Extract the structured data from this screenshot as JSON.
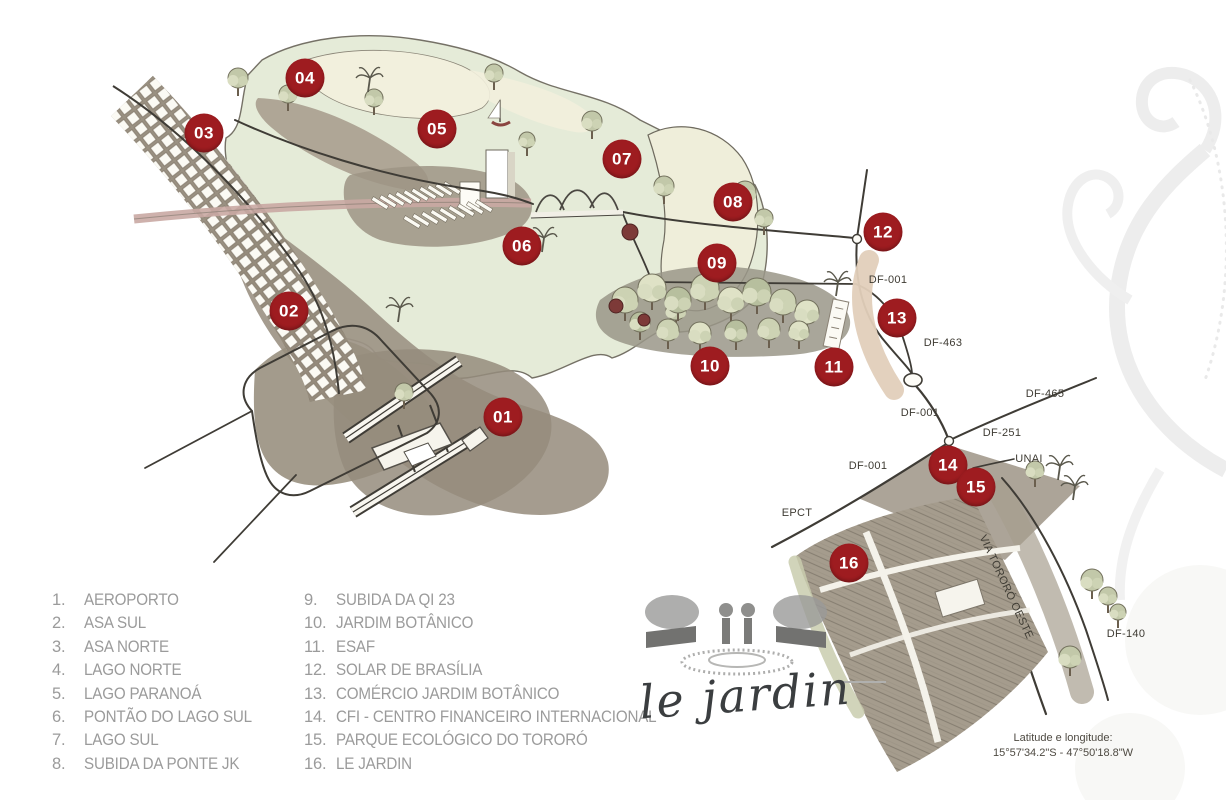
{
  "colors": {
    "marker_bg": "#9e1c20",
    "marker_text": "#ffffff",
    "road_label": "#3e3b33",
    "legend_text": "#9b9b9b",
    "coords_text": "#4e4a42",
    "logo_text": "#3b3e40",
    "water": "#e4ead6",
    "land": "#9d9485",
    "road": "#3f3c36",
    "axis_pink": "#c9a9a3"
  },
  "map": {
    "markers": [
      {
        "num": "01",
        "x": 503,
        "y": 417
      },
      {
        "num": "02",
        "x": 289,
        "y": 311
      },
      {
        "num": "03",
        "x": 204,
        "y": 133
      },
      {
        "num": "04",
        "x": 305,
        "y": 78
      },
      {
        "num": "05",
        "x": 437,
        "y": 129
      },
      {
        "num": "06",
        "x": 522,
        "y": 246
      },
      {
        "num": "07",
        "x": 622,
        "y": 159
      },
      {
        "num": "08",
        "x": 733,
        "y": 202
      },
      {
        "num": "09",
        "x": 717,
        "y": 263
      },
      {
        "num": "10",
        "x": 710,
        "y": 366
      },
      {
        "num": "11",
        "x": 834,
        "y": 367
      },
      {
        "num": "12",
        "x": 883,
        "y": 232
      },
      {
        "num": "13",
        "x": 897,
        "y": 318
      },
      {
        "num": "14",
        "x": 948,
        "y": 465
      },
      {
        "num": "15",
        "x": 976,
        "y": 487
      },
      {
        "num": "16",
        "x": 849,
        "y": 563
      }
    ],
    "road_labels": [
      {
        "text": "DF-001",
        "x": 888,
        "y": 280,
        "rotate": 0
      },
      {
        "text": "DF-463",
        "x": 943,
        "y": 343,
        "rotate": 0
      },
      {
        "text": "DF-465",
        "x": 1045,
        "y": 394,
        "rotate": 0
      },
      {
        "text": "DF-001",
        "x": 920,
        "y": 413,
        "rotate": 0
      },
      {
        "text": "DF-251",
        "x": 1002,
        "y": 433,
        "rotate": 0
      },
      {
        "text": "UNAI",
        "x": 1029,
        "y": 459,
        "rotate": 0
      },
      {
        "text": "DF-001",
        "x": 868,
        "y": 466,
        "rotate": 0
      },
      {
        "text": "EPCT",
        "x": 797,
        "y": 513,
        "rotate": 0
      },
      {
        "text": "DF-140",
        "x": 1126,
        "y": 634,
        "rotate": 0
      },
      {
        "text": "VIA TORORÓ OESTE",
        "x": 1006,
        "y": 587,
        "rotate": 65
      }
    ],
    "decor": {
      "trees": [
        [
          238,
          78,
          10
        ],
        [
          288,
          94,
          9
        ],
        [
          374,
          98,
          9
        ],
        [
          494,
          73,
          9
        ],
        [
          527,
          140,
          8
        ],
        [
          592,
          121,
          10
        ],
        [
          664,
          186,
          10
        ],
        [
          745,
          192,
          11
        ],
        [
          764,
          218,
          9
        ],
        [
          676,
          310,
          10
        ],
        [
          404,
          392,
          9
        ],
        [
          1035,
          470,
          9
        ],
        [
          1092,
          580,
          11
        ],
        [
          1108,
          596,
          9
        ],
        [
          1070,
          657,
          11
        ],
        [
          1118,
          612,
          8
        ]
      ],
      "palms": [
        [
          368,
          92
        ],
        [
          398,
          322
        ],
        [
          542,
          252
        ],
        [
          836,
          296
        ],
        [
          1058,
          480
        ],
        [
          1073,
          500
        ]
      ],
      "forest_trees": [
        [
          625,
          300,
          13
        ],
        [
          652,
          288,
          14
        ],
        [
          678,
          300,
          13
        ],
        [
          705,
          288,
          14
        ],
        [
          731,
          300,
          13
        ],
        [
          757,
          292,
          14
        ],
        [
          783,
          302,
          13
        ],
        [
          807,
          312,
          12
        ],
        [
          640,
          322,
          10
        ],
        [
          668,
          330,
          11
        ],
        [
          700,
          333,
          11
        ],
        [
          736,
          331,
          11
        ],
        [
          769,
          329,
          11
        ],
        [
          799,
          331,
          10
        ]
      ],
      "maroon_trees": [
        [
          630,
          232,
          8
        ],
        [
          616,
          306,
          7
        ],
        [
          644,
          320,
          6
        ]
      ],
      "esplanade_rows": [
        {
          "x1": 380,
          "y1": 203,
          "x2": 452,
          "y2": 188,
          "n": 10
        },
        {
          "x1": 412,
          "y1": 222,
          "x2": 484,
          "y2": 206,
          "n": 9
        }
      ]
    }
  },
  "legend": {
    "columns": [
      [
        {
          "num": "1.",
          "label": "AEROPORTO"
        },
        {
          "num": "2.",
          "label": "ASA SUL"
        },
        {
          "num": "3.",
          "label": "ASA NORTE"
        },
        {
          "num": "4.",
          "label": "LAGO NORTE"
        },
        {
          "num": "5.",
          "label": "LAGO PARANOÁ"
        },
        {
          "num": "6.",
          "label": "PONTÃO DO LAGO SUL"
        },
        {
          "num": "7.",
          "label": "LAGO SUL"
        },
        {
          "num": "8.",
          "label": "SUBIDA DA PONTE JK"
        }
      ],
      [
        {
          "num": "9.",
          "label": "SUBIDA DA QI 23"
        },
        {
          "num": "10.",
          "label": "JARDIM BOTÂNICO"
        },
        {
          "num": "11.",
          "label": "ESAF"
        },
        {
          "num": "12.",
          "label": "SOLAR DE BRASÍLIA"
        },
        {
          "num": "13.",
          "label": "COMÉRCIO JARDIM BOTÂNICO"
        },
        {
          "num": "14.",
          "label": "CFI - CENTRO FINANCEIRO INTERNACIONAL"
        },
        {
          "num": "15.",
          "label": "PARQUE ECOLÓGICO DO TORORÓ"
        },
        {
          "num": "16.",
          "label": "LE JARDIN"
        }
      ]
    ]
  },
  "logo": {
    "text": "le jardin"
  },
  "coordinates": {
    "line1": "Latitude e longitude:",
    "line2": "15°57'34.2\"S - 47°50'18.8\"W"
  }
}
